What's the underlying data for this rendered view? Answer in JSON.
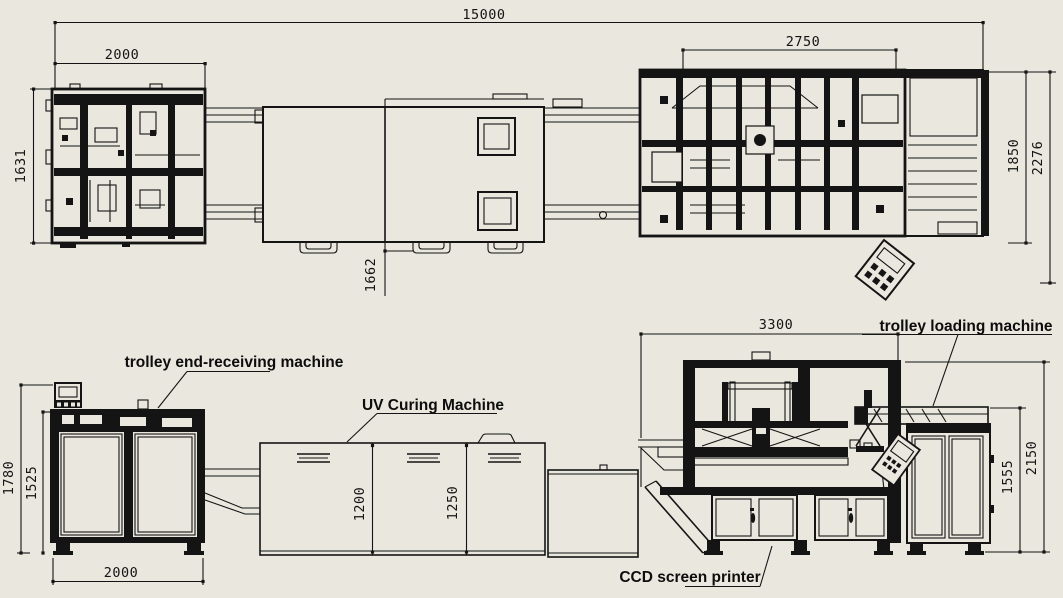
{
  "drawing": {
    "background_color": "#e9e7de",
    "line_color": "#141414",
    "machine_labels": {
      "end_receiving": "trolley end-receiving machine",
      "uv_curing": "UV Curing Machine",
      "loading": "trolley loading machine",
      "ccd_printer": "CCD screen printer"
    },
    "dimensions_mm": {
      "top_view": {
        "overall_length": "15000",
        "end_machine_width": "2000",
        "end_machine_depth": "1631",
        "printer_section_width": "2750",
        "conveyor_depth": "1662",
        "loader_depth": "1850",
        "loader_overall_depth": "2276"
      },
      "side_view": {
        "end_machine_height": "1780",
        "end_machine_body_height": "1525",
        "end_machine_width": "2000",
        "uv_section_height_1": "1200",
        "uv_section_height_2": "1250",
        "printer_width": "3300",
        "loader_height": "1555",
        "printer_height": "2150"
      }
    }
  }
}
